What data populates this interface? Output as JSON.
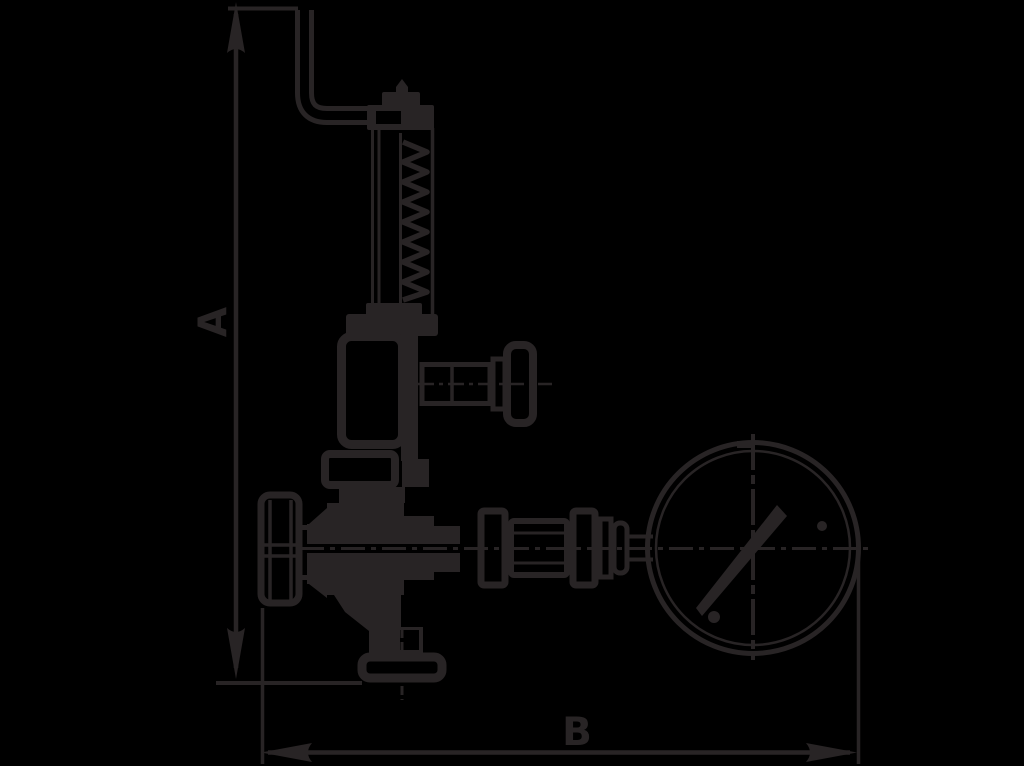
{
  "drawing": {
    "type": "technical-line-drawing",
    "dimension_labels": {
      "vertical": "A",
      "horizontal": "B"
    },
    "colors": {
      "background": "#000000",
      "line": "#282425"
    },
    "icons": [
      "up-arrowhead-icon",
      "down-arrowhead-icon",
      "left-arrowhead-icon",
      "right-arrowhead-icon",
      "pressure-gauge-icon",
      "gauge-needle-icon"
    ]
  }
}
